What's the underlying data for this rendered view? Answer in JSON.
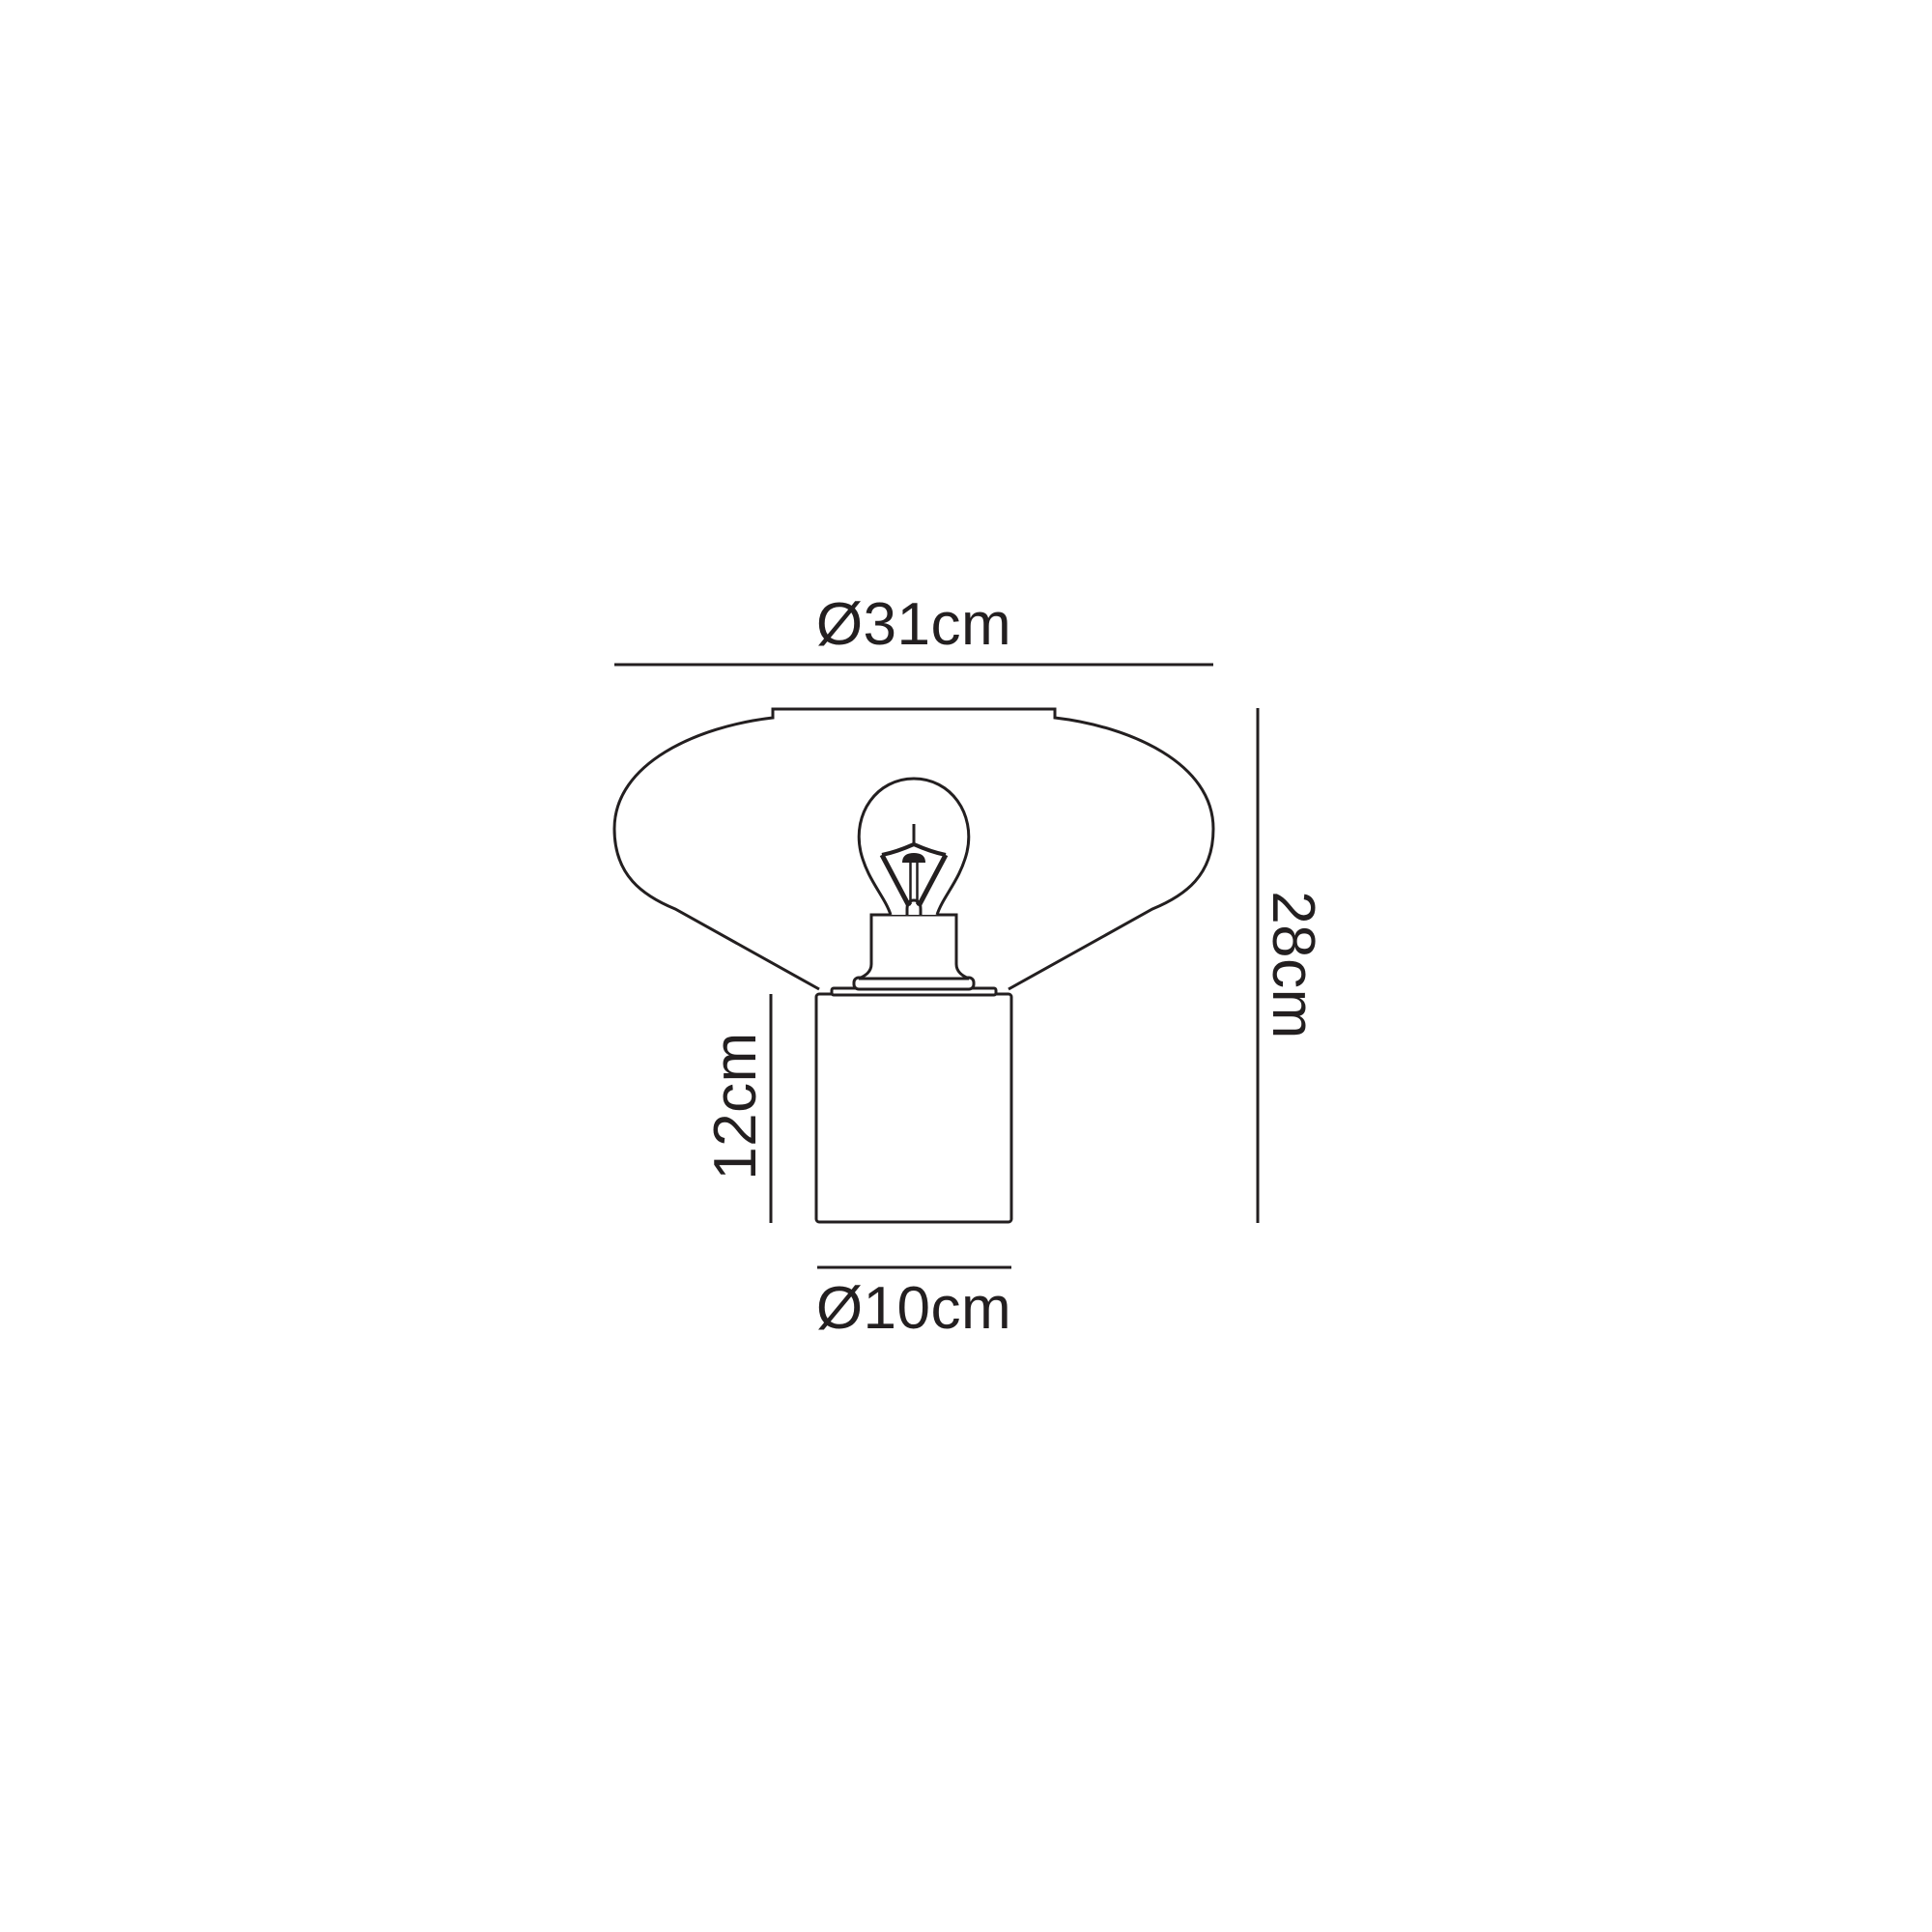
{
  "page": {
    "background_color": "#ffffff"
  },
  "drawing": {
    "description": "Technical dimension line drawing of a table lamp: wide rounded conical shade with notched top, exposed filament bulb in flared socket, cylindrical base",
    "line_color": "#231f20",
    "labels": {
      "shade_diameter": "Ø31cm",
      "overall_height": "28cm",
      "base_height": "12cm",
      "base_diameter": "Ø10cm"
    }
  }
}
